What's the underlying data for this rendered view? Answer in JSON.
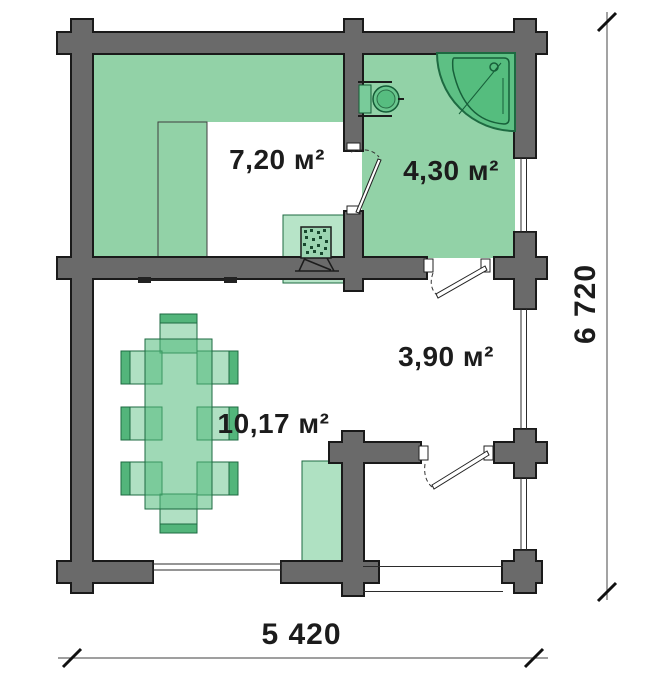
{
  "plan": {
    "type": "floor-plan",
    "rooms": [
      {
        "id": "sauna",
        "area": "7,20 м²"
      },
      {
        "id": "washroom",
        "area": "4,30 м²"
      },
      {
        "id": "lounge",
        "area": "10,17 м²"
      },
      {
        "id": "hallway",
        "area": "3,90 м²"
      }
    ],
    "dimensions": {
      "height": "6 720",
      "width": "5 420"
    },
    "colors": {
      "wall_fill": "#6a6a6a",
      "wall_outline": "#1a1a1a",
      "room_green": "#92d2a7",
      "fixture_green": "#5dc084",
      "furniture_outline": "#1d6a41",
      "text": "#1c1c1c"
    },
    "fixtures": [
      "corner-shower",
      "toilet",
      "sauna-stove",
      "sauna-bench-tier",
      "dining-table",
      "chairs",
      "counter",
      "wall-bench"
    ]
  }
}
